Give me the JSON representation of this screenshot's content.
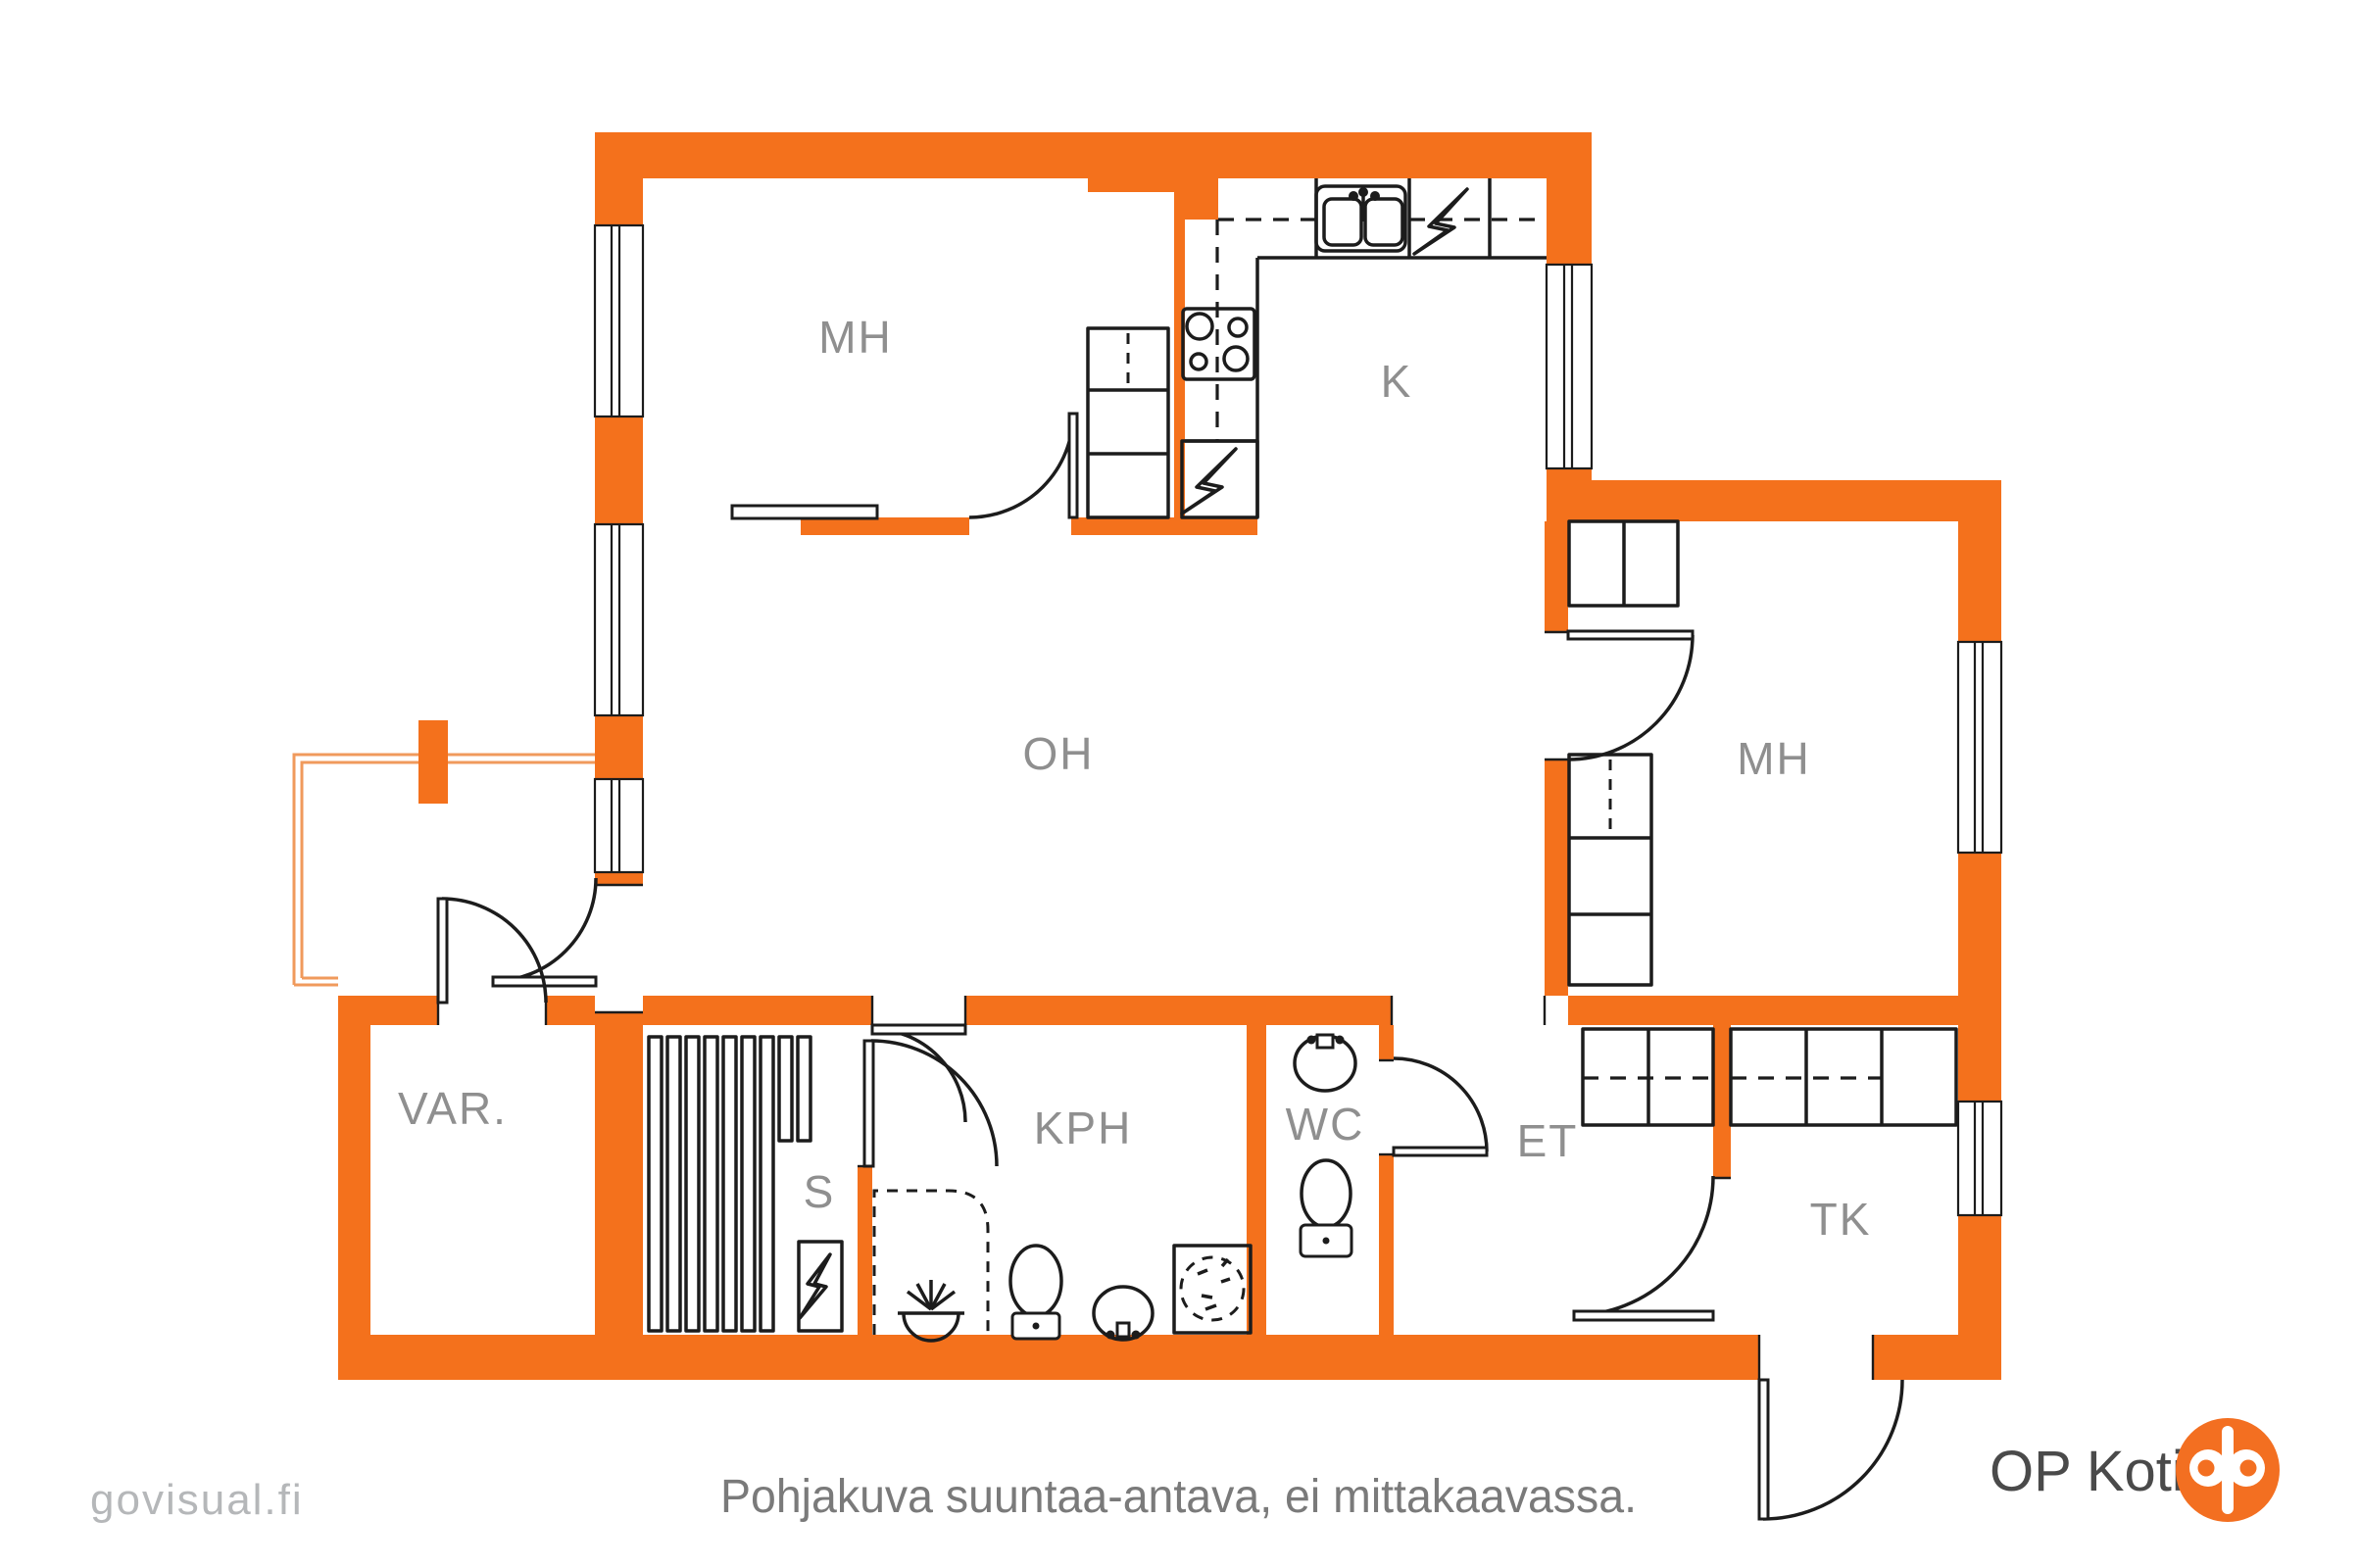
{
  "colors": {
    "wall": "#f4711c",
    "ink": "#1c1c1c",
    "label": "#8f8f8f",
    "caption": "#7a7a7a",
    "watermark": "#b5b7b9",
    "brand_text": "#4a4a4a",
    "brand_orange": "#f36f21",
    "rail": "#f09a5c"
  },
  "rooms": [
    {
      "id": "mh-top-left",
      "label": "MH"
    },
    {
      "id": "kitchen",
      "label": "K"
    },
    {
      "id": "living-room",
      "label": "OH"
    },
    {
      "id": "mh-right",
      "label": "MH"
    },
    {
      "id": "storage",
      "label": "VAR."
    },
    {
      "id": "sauna",
      "label": "S"
    },
    {
      "id": "bathroom",
      "label": "KPH"
    },
    {
      "id": "toilet",
      "label": "WC"
    },
    {
      "id": "entry",
      "label": "ET"
    },
    {
      "id": "utility",
      "label": "TK"
    }
  ],
  "fixtures": [
    "kitchen-sink",
    "dishwasher-lightning",
    "stove-4-burners",
    "appliance-lightning",
    "sauna-heater-lightning",
    "sauna-benches",
    "shower-dashed",
    "floor-drain",
    "toilet",
    "washbasin",
    "washing-machine",
    "wardrobe",
    "coat-closet",
    "balcony-railing",
    "window",
    "door-arc"
  ],
  "footer": {
    "watermark": "govisual.fi",
    "caption": "Pohjakuva suuntaa-antava, ei mittakaavassa.",
    "brand": "OP Koti"
  }
}
